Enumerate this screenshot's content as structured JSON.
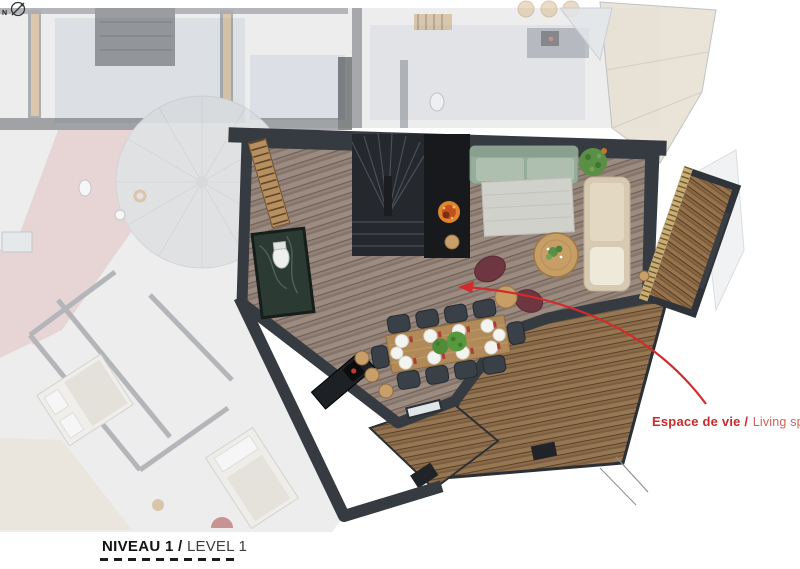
{
  "document": {
    "kind": "architectural-floor-plan-rendering",
    "background_color": "#ffffff",
    "style": "top-down 3D rendered plan, highlighted apartment over faded surrounding plan"
  },
  "footer": {
    "level_label_primary": "NIVEAU 1 /",
    "level_label_secondary": "LEVEL 1",
    "north_indicator_letter": "N",
    "underline_style": "black dashed rule"
  },
  "callout": {
    "text_primary": "Espace de vie /",
    "text_secondary": "Living space",
    "primary_color": "#c82b2a",
    "secondary_color": "#d4615b",
    "arrow_color": "#d22b2b",
    "arrow_description": "red curved leader from label to the living room"
  },
  "plan": {
    "highlighted_area_summary": "open living space with staircase, fireplace, green sofa, beige sofa, rug, round coffee table, two red armchairs, dining table for ten with plates and green centerpieces, black kitchen island with three stools, powder room, bookshelf wall, wood balcony and two wood deck terraces",
    "faded_context_summary": "adjacent apartment rooms, corridors, turret roof and neighbouring roofs shown washed out",
    "furniture_icons": [
      "staircase-icon",
      "fireplace-icon",
      "green-sofa-icon",
      "beige-sofa-icon",
      "rug-icon",
      "coffee-table-icon",
      "armchair-icon",
      "side-table-icon",
      "dining-table-icon",
      "dining-chair-icon",
      "plate-icon",
      "centerpiece-plant-icon",
      "kitchen-island-icon",
      "bar-stool-icon",
      "powder-room-icon",
      "toilet-icon",
      "bookshelf-icon",
      "balcony-deck-icon",
      "terrace-deck-icon",
      "turret-roof-icon",
      "bed-icon",
      "north-compass-icon"
    ],
    "palette": {
      "wall_dark": "#363b42",
      "floor_wood": "#93827a",
      "deck_wood": "#8a6b4b",
      "table_wood": "#b08a58",
      "sofa_green": "#97ad9c",
      "sofa_beige": "#d7cab3",
      "armchair_red": "#6d3640",
      "plant_green": "#5a8f45",
      "stool_tan": "#c89f6b",
      "faded_pink": "#e3bfbf",
      "faded_roof_beige": "#e7dfd2",
      "accent_red": "#d22b2b"
    }
  }
}
